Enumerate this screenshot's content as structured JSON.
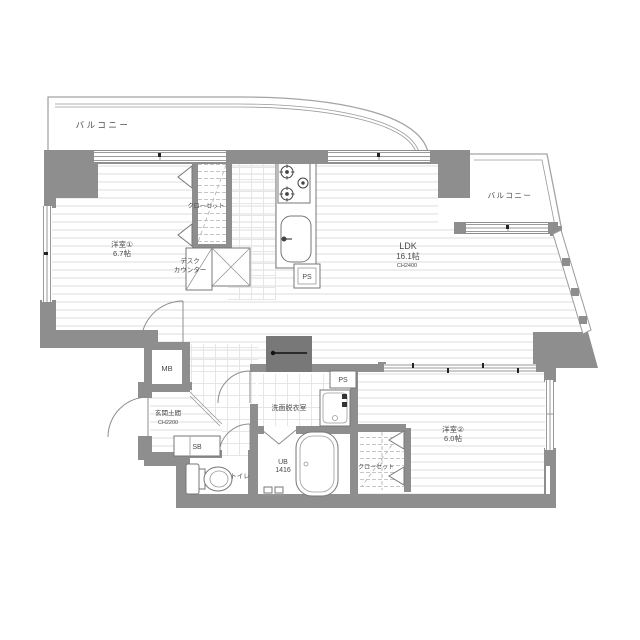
{
  "plan": {
    "type": "japanese-apartment-floor-plan",
    "colors": {
      "wall": "#8e8e8e",
      "wall_dark": "#787878",
      "floor_line": "#dcdcdc",
      "grid_line": "#e6e6e6",
      "outline": "#a4a4a4",
      "text": "#4a4a4a",
      "fixture": "#777777"
    },
    "labels": {
      "balcony_left": "バルコニー",
      "balcony_right": "バルコニー",
      "room1_name": "洋室①",
      "room1_size": "6.7帖",
      "room1_closet": "クローゼット",
      "desk_line1": "デスク",
      "desk_line2": "カウンター",
      "ps_kitchen": "PS",
      "ldk_name": "LDK",
      "ldk_size": "16.1帖",
      "ldk_ch": "CH2400",
      "mb": "MB",
      "genkan_name": "玄関土間",
      "genkan_ch": "CH2200",
      "sb": "SB",
      "toilet": "トイレ",
      "washroom": "洗面脱衣室",
      "ps_bath": "PS",
      "ub_name": "UB",
      "ub_size": "1416",
      "room2_name": "洋室②",
      "room2_size": "6.0帖",
      "room2_closet": "クローゼット"
    }
  }
}
